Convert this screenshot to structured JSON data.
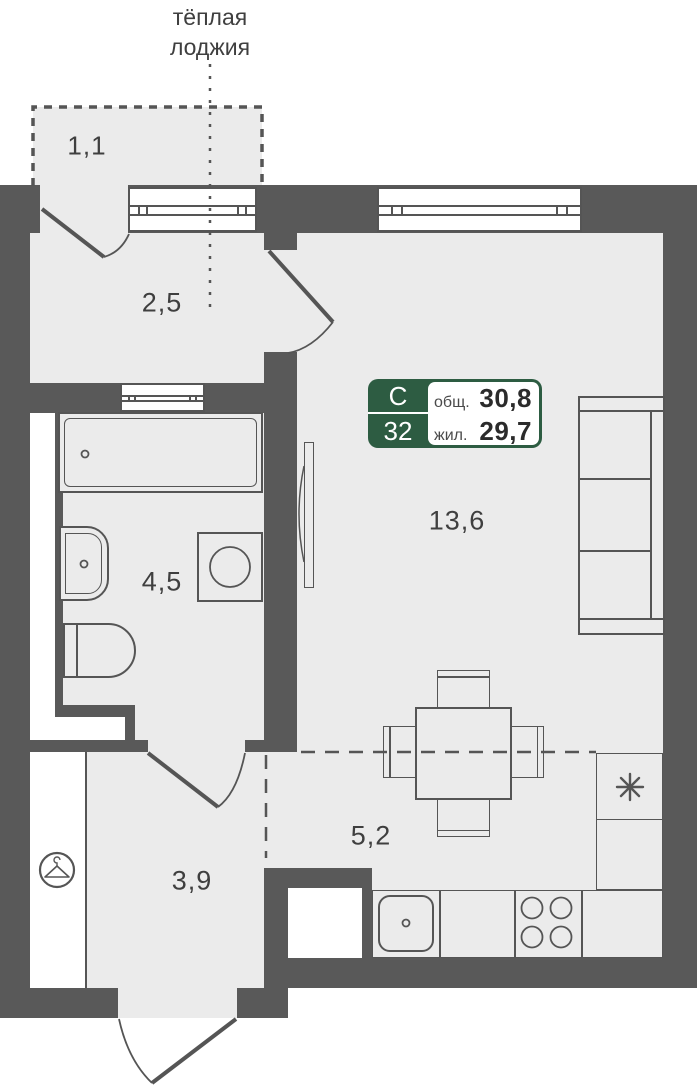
{
  "plan": {
    "loggia_label_line1": "тёплая",
    "loggia_label_line2": "лоджия",
    "rooms": {
      "balcony": "1,1",
      "hall": "2,5",
      "bathroom": "4,5",
      "living": "13,6",
      "kitchen": "5,2",
      "entry": "3,9"
    }
  },
  "badge": {
    "type_letter": "С",
    "unit_number": "32",
    "total_label": "общ.",
    "total_value": "30,8",
    "living_label": "жил.",
    "living_value": "29,7"
  },
  "colors": {
    "wall": "#595959",
    "outline": "#555555",
    "floor": "#ebebeb",
    "badge_green": "#2d5c42",
    "text": "#3f3f3f"
  },
  "icons": {
    "wardrobe": "hanger-icon",
    "fridge": "snowflake-icon",
    "stove": "burners-icon",
    "sink": "drain-dot-icon"
  }
}
